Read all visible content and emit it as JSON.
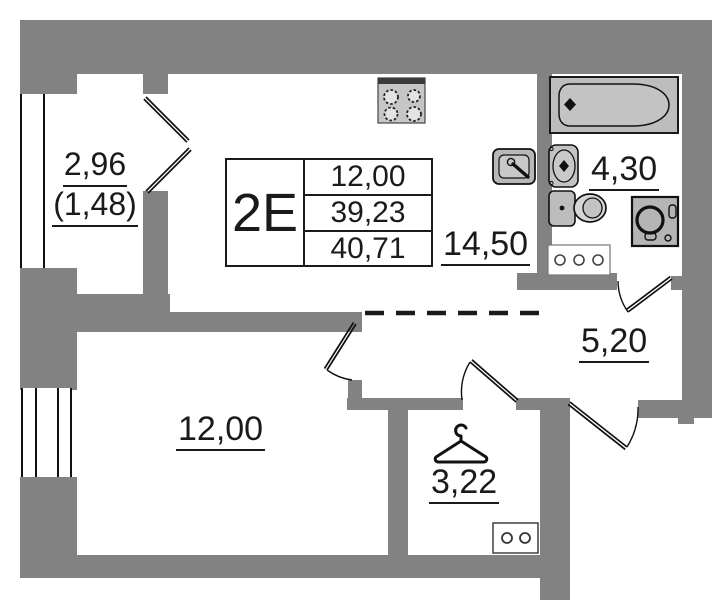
{
  "unit": {
    "label": "2E",
    "area_rows": [
      "12,00",
      "39,23",
      "40,71"
    ]
  },
  "rooms": {
    "balcony": {
      "area": "2,96",
      "area_secondary": "(1,48)"
    },
    "kitchen_living": {
      "area": "14,50"
    },
    "bathroom": {
      "area": "4,30"
    },
    "hallway": {
      "area": "5,20"
    },
    "bedroom": {
      "area": "12,00"
    },
    "wardrobe": {
      "area": "3,22"
    }
  },
  "icons": [
    "stove-icon",
    "kitchen-sink-icon",
    "bathtub-icon",
    "washbasin-icon",
    "toilet-icon",
    "washing-machine-icon",
    "ventilation-grille-icon",
    "electrical-panel-icon",
    "hanger-icon",
    "balcony-door-icon",
    "door-leaf",
    "door-swing-arc",
    "window-icon",
    "zone-dashed-line"
  ],
  "colors": {
    "wall": "#828282",
    "fixture": "#c3c3c3",
    "fixture_dark": "#b5b5b5",
    "outline": "#111111",
    "text": "#1a1a1a",
    "background": "#ffffff"
  }
}
